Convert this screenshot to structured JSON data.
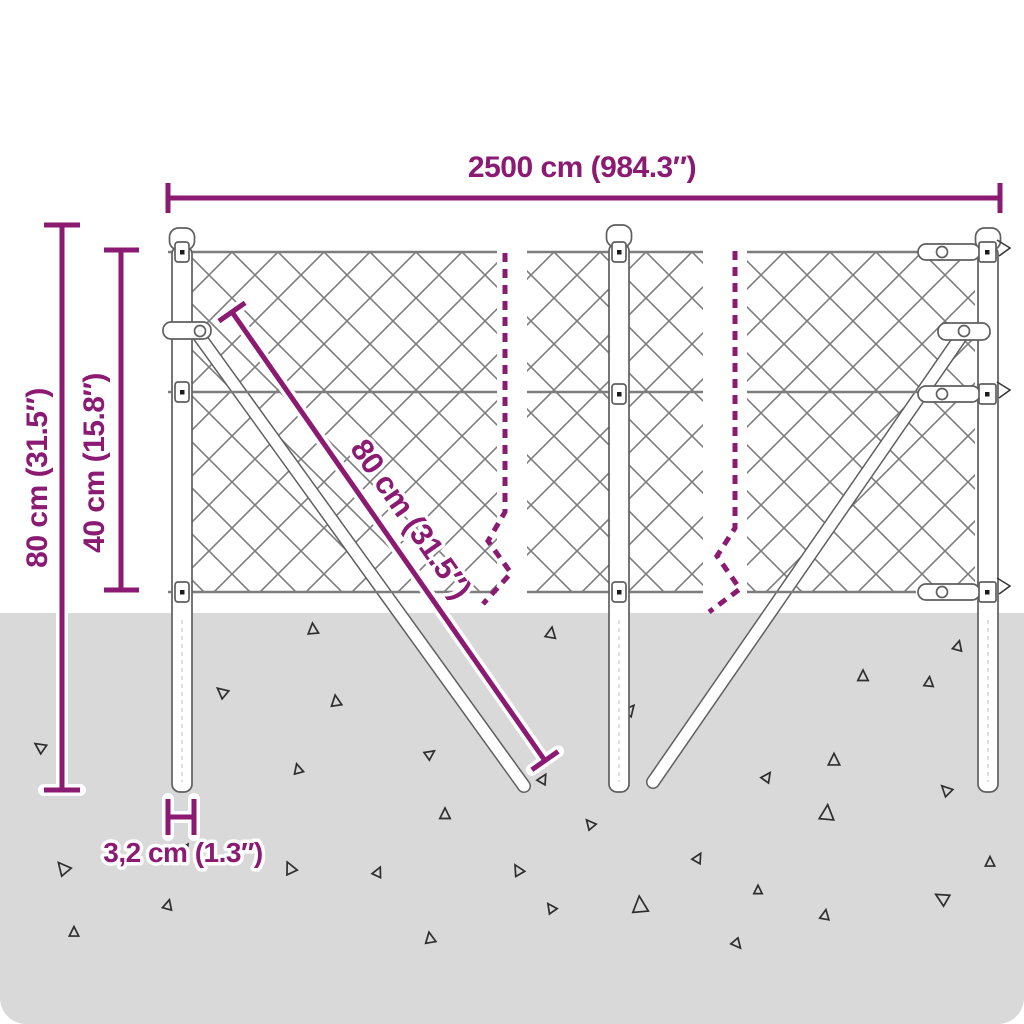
{
  "colors": {
    "bg": "#ffffff",
    "ground": "#d9d9d9",
    "accent": "#8a1a72",
    "wire": "#7d7d7d",
    "outline": "#5f5f5f",
    "debris": "#2e2e2e"
  },
  "labels": {
    "total_length": "2500 cm (984.3″)",
    "post_height": "80 cm (31.5″)",
    "mesh_height": "40 cm (15.8″)",
    "brace_length": "80 cm (31.5″)",
    "post_diameter": "3,2 cm (1.3″)"
  }
}
